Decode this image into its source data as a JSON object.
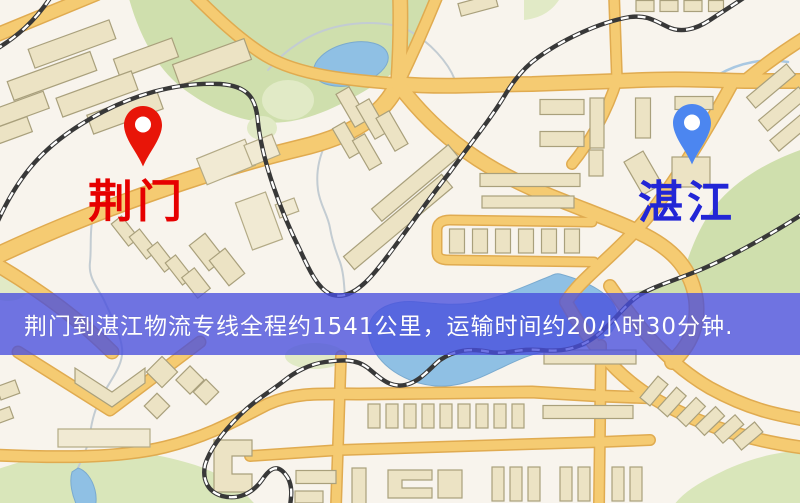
{
  "map": {
    "origin": {
      "label": "荆门",
      "pin_color": "#e81508",
      "label_color": "#e60000"
    },
    "destination": {
      "label": "湛江",
      "pin_color": "#4c86f0",
      "label_color": "#2226d6"
    },
    "banner": {
      "text": "荆门到湛江物流专线全程约1541公里，运输时间约20小时30分钟.",
      "bg_color": "rgba(72,78,222,0.78)",
      "text_color": "#ffffff"
    },
    "palette": {
      "background": "#f8f4ed",
      "road_fill": "#f5cb72",
      "road_casing": "#e0ab50",
      "park_green": "#cfdfad",
      "water_blue": "#8fc0e4",
      "railway_dark": "#383838",
      "building_beige": "#ece3c4"
    }
  }
}
